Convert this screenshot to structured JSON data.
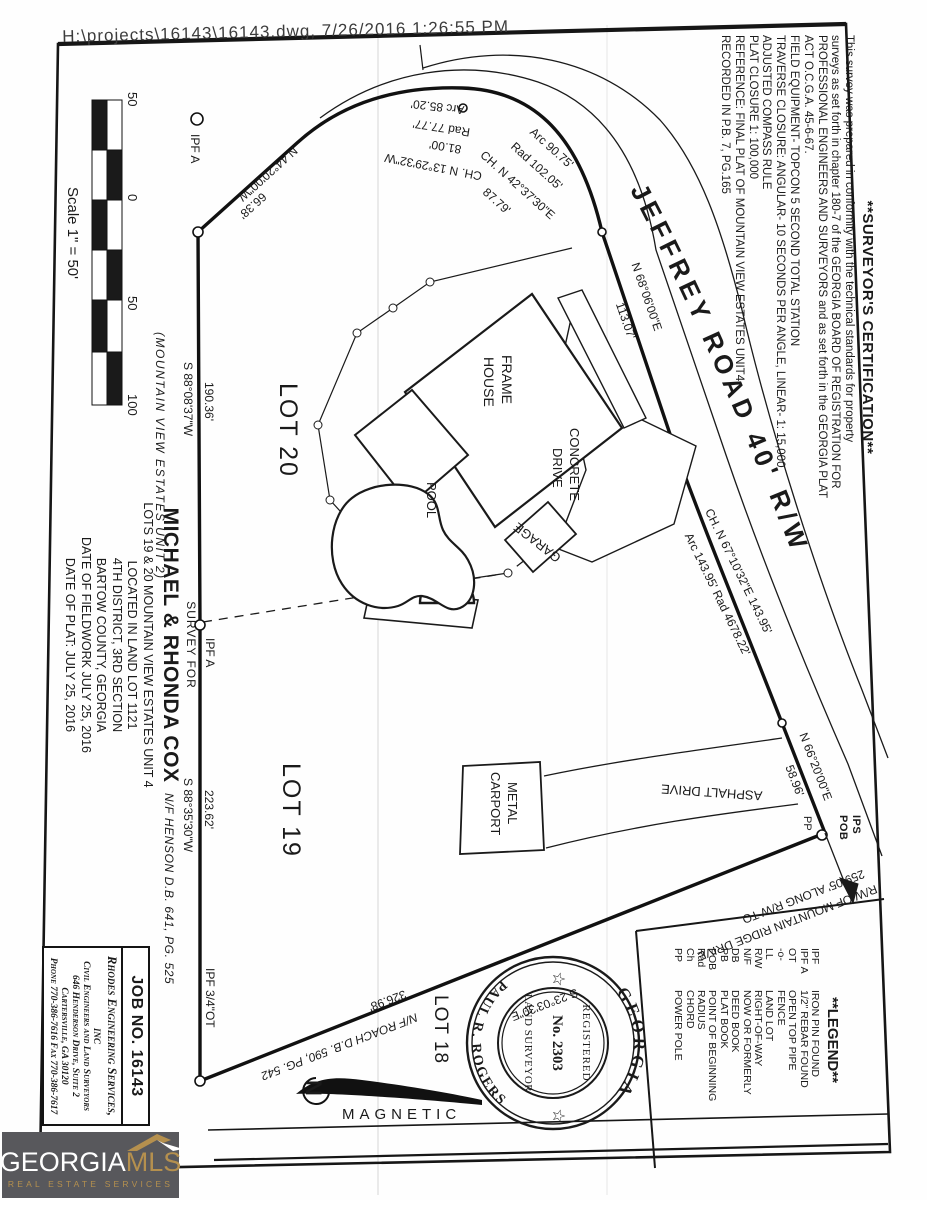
{
  "stamp": "H:\\projects\\16143\\16143.dwg, 7/26/2016 1:26:55 PM",
  "colors": {
    "ink": "#1a1a1a",
    "logo_bg": "#58585c",
    "logo_gold": "#b5904e",
    "logo_white": "#ffffff"
  },
  "scale_bar": {
    "labels": [
      "50",
      "0",
      "50",
      "100"
    ],
    "caption": "Scale 1\" = 50'"
  },
  "road": {
    "name_label": "JEFFREY  ROAD  40'  R/W"
  },
  "bearings": {
    "nw_line": {
      "bearing": "N 44°20'00\"W",
      "distance": "66.38'"
    },
    "curve1": {
      "arc": "Arc 85.20'",
      "rad": "Rad 77.77'",
      "chord_len": "81.00'",
      "chord": "CH. N 13°29'32\"W"
    },
    "curve2": {
      "arc": "Arc 90.75'",
      "rad": "Rad 102.05'",
      "chord": "CH. N 42°37'30\"E",
      "chord_len": "87.79'"
    },
    "road_tangent": {
      "bearing": "N 68°06'00\"E",
      "distance": "113.07'"
    },
    "curve3": {
      "chord": "CH. N 67°10'32\"E  143.95'",
      "arc_rad": "Arc 143.95'  Rad 4678.22'"
    },
    "road_end": {
      "bearing": "N 66°20'00\"E",
      "distance": "58.96'"
    },
    "south_line": {
      "bearing": "S 23°03'30\"E",
      "distance": "326.98'"
    },
    "west_upper": {
      "bearing": "S 88°08'37\"W",
      "distance": "190.36'"
    },
    "west_lower": {
      "bearing": "S 88°35'30\"W",
      "distance": "223.62'"
    },
    "rw_tie": {
      "line1": "259.05' ALONG R/W TO",
      "line2": "R/W OF MOUNTAIN RIDGE DRIVE"
    }
  },
  "markers": {
    "ipf_nw": "IPF A",
    "ipf_mid": "IPF A",
    "ipf_sw": "IPF 3/4\"OT",
    "ips": "IPS",
    "pob": "POB",
    "pp": "PP"
  },
  "lots": {
    "lot20": "LOT 20",
    "lot19": "LOT 19",
    "lot18": "LOT 18"
  },
  "neighbors": {
    "henson": "N/F HENSON D.B. 641, PG. 525",
    "roach": "N/F ROACH D.B. 590, PG. 542",
    "mve2": "(MOUNTAIN VIEW ESTATES UNIT 2)"
  },
  "site": {
    "house1": "FRAME",
    "house2": "HOUSE",
    "pool": "POOL",
    "garage": "GARAGE",
    "drive1": "CONCRETE",
    "drive2": "DRIVE",
    "carport1": "METAL",
    "carport2": "CARPORT",
    "asphalt": "ASPHALT DRIVE"
  },
  "north": {
    "n": "N",
    "label": "MAGNETIC"
  },
  "title_block": {
    "survey_for": "SURVEY FOR",
    "client": "MICHAEL & RHONDA COX",
    "lines": [
      "LOTS 19 & 20 MOUNTAIN VIEW ESTATES UNIT 4",
      "LOCATED IN LAND LOT 1121",
      "4TH DISTRICT, 3RD SECTION",
      "BARTOW COUNTY, GEORGIA",
      "DATE OF FIELDWORK JULY 25, 2016",
      "DATE OF PLAT: JULY 25, 2016"
    ]
  },
  "firm": {
    "job": "JOB NO. 16143",
    "name": "Rhodes Engineering Services, inc",
    "lines": [
      "Civil Engineers and Land Surveyors",
      "646 Henderson Drive, Suite 2",
      "Cartersville, GA  30120",
      "Phone 770-386-7616  Fax 770-386-7617"
    ]
  },
  "certification": {
    "heading": "**SURVEYOR'S CERTIFICATION**",
    "lines": [
      "This survey was prepared in conformity with the technical standards for property",
      "surveys as set forth in chapter 180-7 of the GEORGIA BOARD OF REGISTRATION FOR",
      "PROFESSIONAL ENGINEERS AND SURVEYORS and as set forth in the GEORGIA PLAT",
      "ACT O.C.G.A. 45-6-67.",
      "FIELD EQUIPMENT- TOPCON 5 SECOND TOTAL STATION",
      "TRAVERSE CLOSURE: ANGULAR- 10 SECONDS PER ANGLE, LINEAR- 1: 15,000",
      "ADJUSTED COMPASS RULE",
      "PLAT CLOSURE 1: 100,000",
      "REFERENCE: FINAL PLAT OF MOUNTAIN VIEW ESTATES UNIT4",
      "RECORDED IN P.B. 7, PG.165"
    ]
  },
  "legend": {
    "heading": "**LEGEND**",
    "items": [
      {
        "abbr": "IPF",
        "label": "IRON PIN FOUND"
      },
      {
        "abbr": "IPF A",
        "label": "1/2\" REBAR FOUND"
      },
      {
        "abbr": "OT",
        "label": "OPEN TOP PIPE"
      },
      {
        "abbr": "-o-",
        "label": "FENCE"
      },
      {
        "abbr": "LL",
        "label": "LAND LOT"
      },
      {
        "abbr": "R/W",
        "label": "RIGHT-OF-WAY"
      },
      {
        "abbr": "N/F",
        "label": "NOW OR FORMERLY"
      },
      {
        "abbr": "DB",
        "label": "DEED BOOK"
      },
      {
        "abbr": "PB",
        "label": "PLAT BOOK"
      },
      {
        "abbr": "POB",
        "label": "POINT OF BEGINNING"
      },
      {
        "abbr": "Rad",
        "label": "RADIUS"
      },
      {
        "abbr": "Ch",
        "label": "CHORD"
      },
      {
        "abbr": "PP",
        "label": "POWER POLE"
      }
    ]
  },
  "seal": {
    "state": "GEORGIA",
    "name": "PAUL R. ROGERS",
    "registered": "REGISTERED",
    "number": "No. 2303",
    "title": "LAND SURVEYOR",
    "star": "☆"
  },
  "logo": {
    "name_white": "GEORGIA",
    "name_gold": "MLS",
    "tagline": "REAL ESTATE SERVICES"
  }
}
